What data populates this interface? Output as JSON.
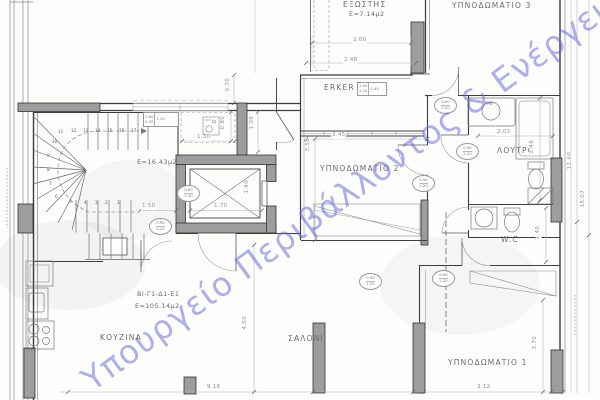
{
  "drawing": {
    "watermark": "Υπουργείο Περιβάλλοντος & Ενέργειας",
    "watermark_color": "#6468d8",
    "apartment_code": "ΒΙ-Γ1-Δ1-Ε1",
    "apartment_area": "Ε=105.14μ2"
  },
  "rooms": {
    "balcony": "ΕΞΩΣΤΗΣ",
    "balcony_area": "Ε=7.14μ2",
    "erker": "ERKER",
    "bedroom3": "ΥΠΝΟΔΩΜΑΤΙΟ 3",
    "bedroom2": "ΥΠΝΟΔΩΜΑΤΙΟ 2",
    "bedroom1": "ΥΠΝΟΔΩΜΑΤΙΟ 1",
    "bathroom": "ΛΟΥΤΡΟ",
    "wc": "W.C",
    "living": "ΣΑΛΟΝΙ",
    "kitchen": "ΚΟΥΖΙΝΑ",
    "stairwell_area": "Ε=16.43μ2"
  },
  "dims": {
    "w200": "2.00",
    "w248": "2.48",
    "w345": "3.45",
    "w202": "2.02",
    "v246": "2.46",
    "v1260": "12.60",
    "v1507": "15.07",
    "w130": "1.30",
    "v080": "0.80",
    "v108": "1.08",
    "v358": "3.58",
    "w150": "1.50",
    "w170": "1.70",
    "v140a": "1.40",
    "v140b": "1.40",
    "w916": "9.16",
    "v450": "4.50",
    "w312": "3.12",
    "v370": "3.70",
    "v070": "0.70"
  },
  "tags": {
    "door_w": "0.90",
    "door_h": "2.20",
    "win1_a": "2.80",
    "win1_b": "2.45",
    "win1_c": "1.20",
    "win2_a": "1.50",
    "win2_b": "2.20",
    "win2_c": "1.40"
  },
  "stairs": {
    "numbers": [
      "1",
      "2",
      "3",
      "4",
      "5",
      "6",
      "7",
      "8",
      "9",
      "10",
      "11",
      "12",
      "13",
      "14",
      "15",
      "16",
      "17"
    ]
  }
}
